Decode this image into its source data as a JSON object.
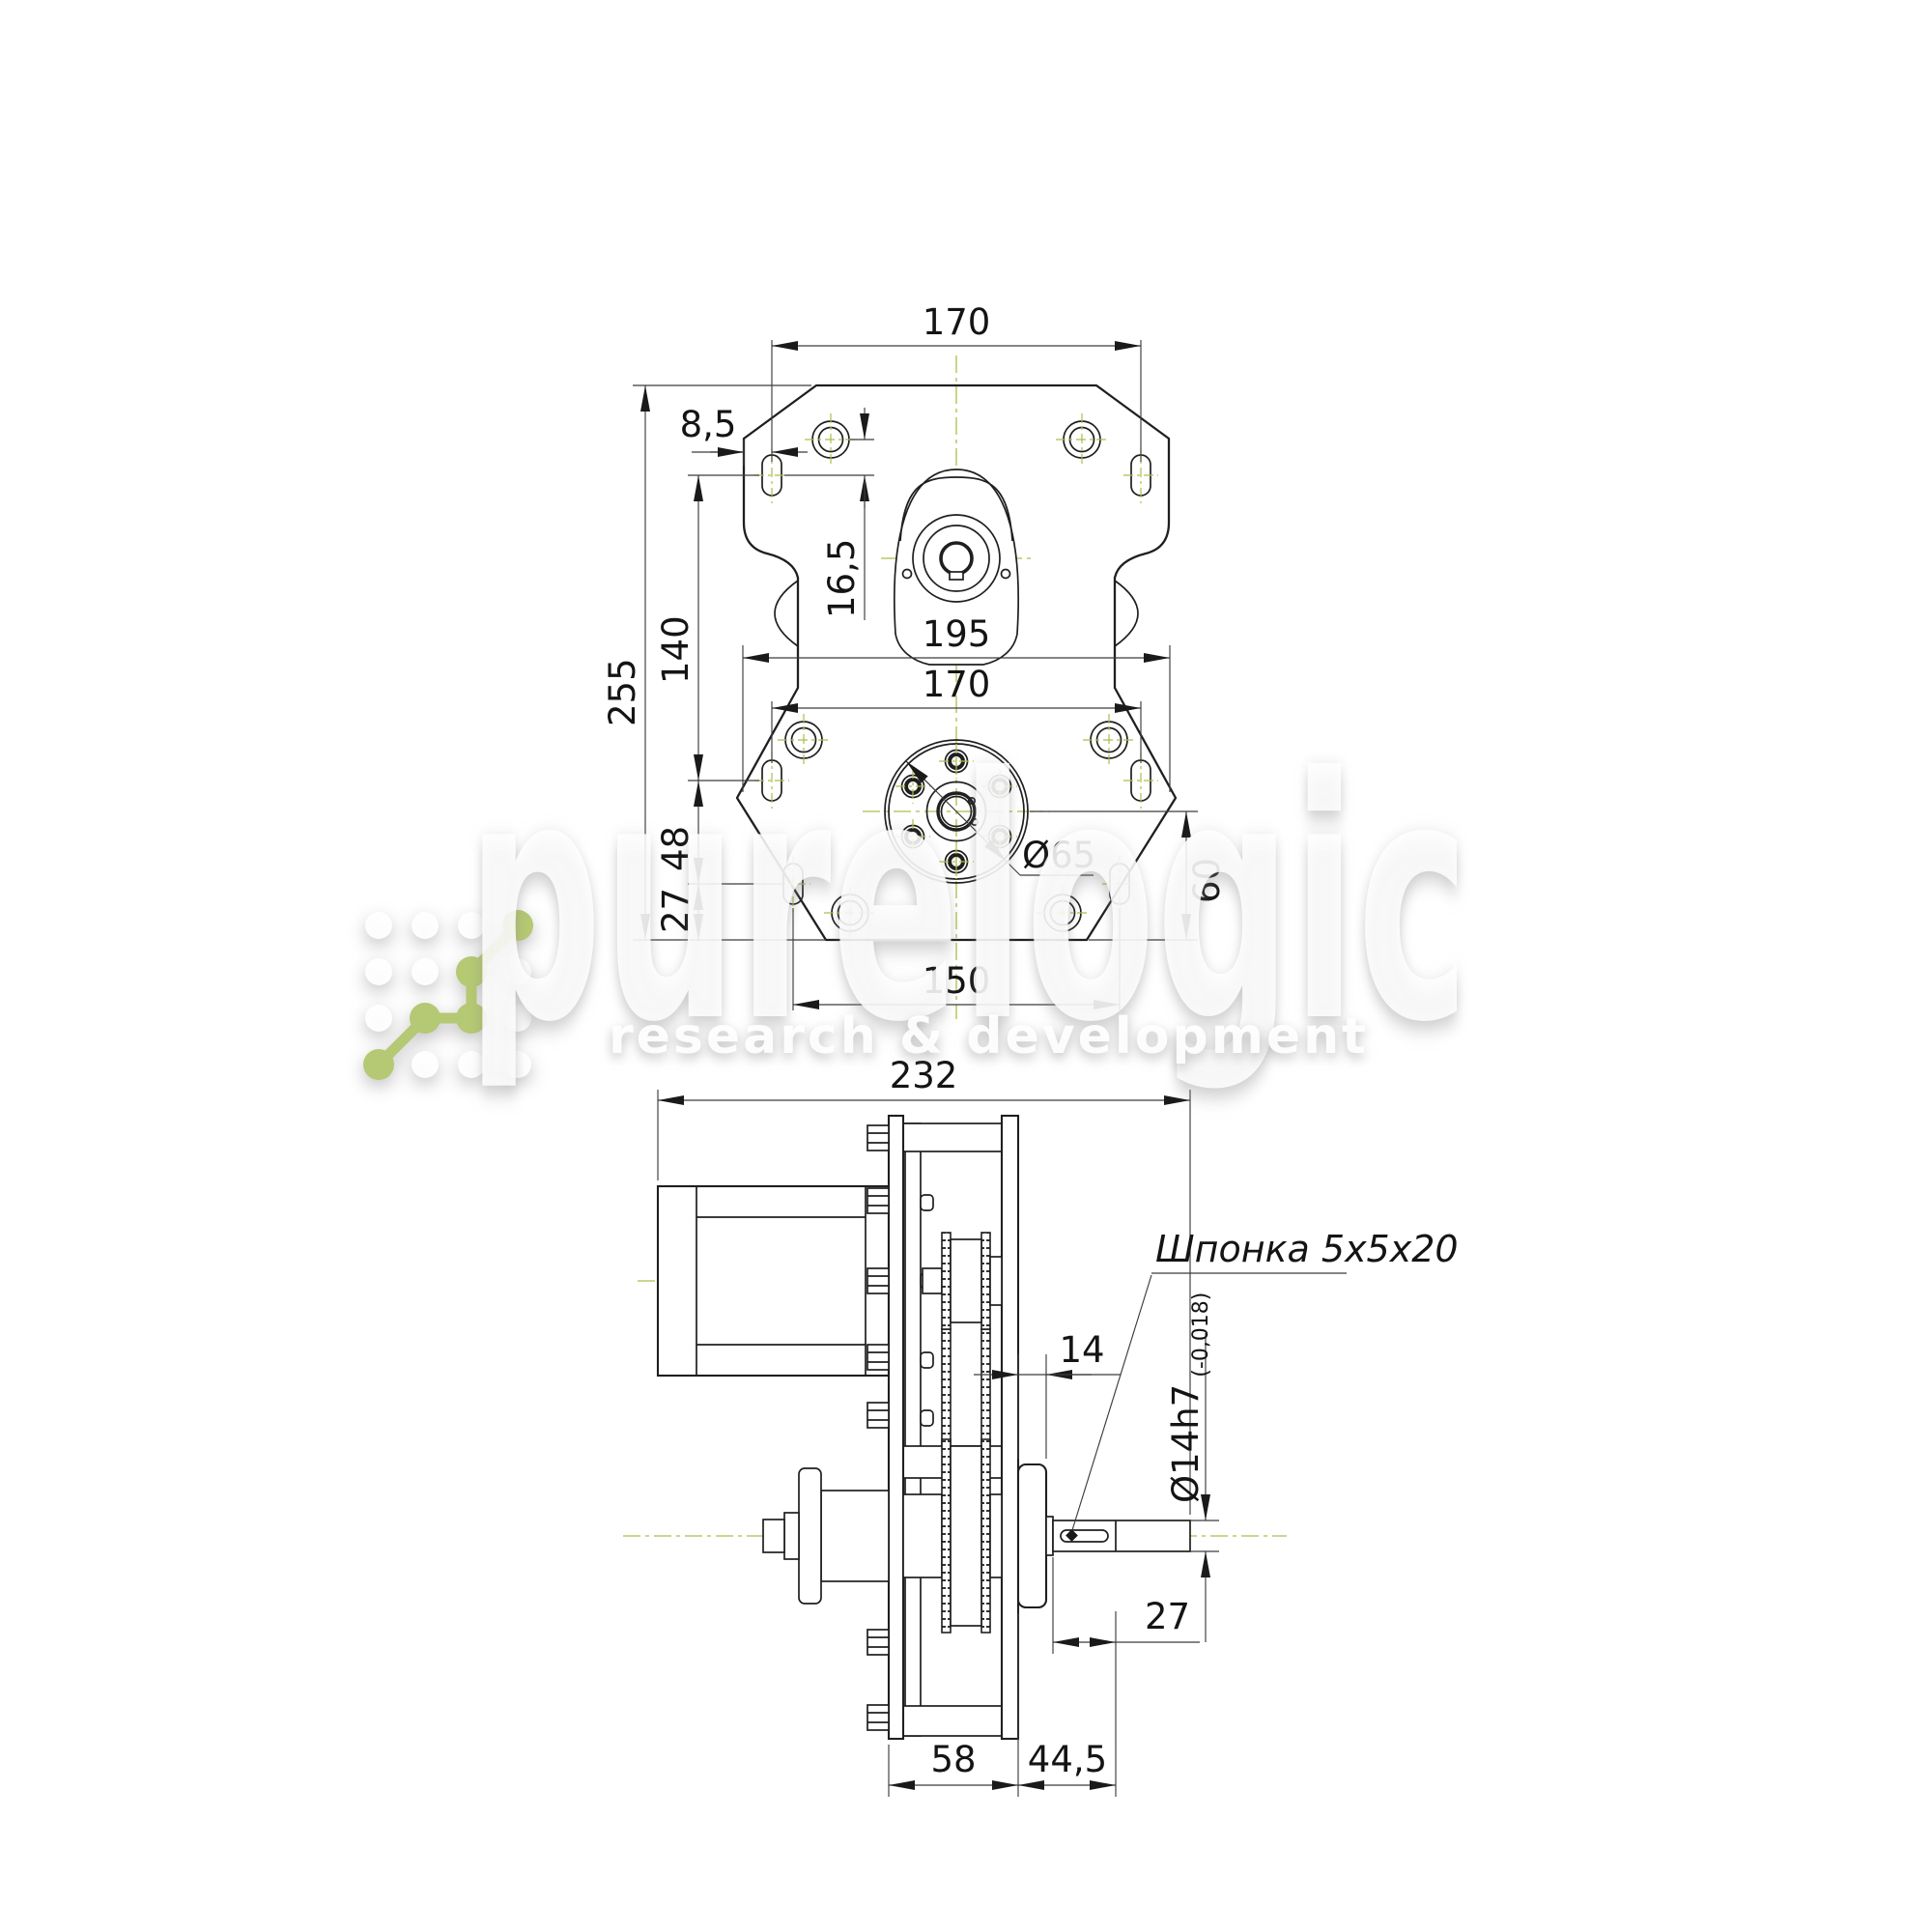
{
  "watermark": {
    "brand": "purelogic",
    "tagline": "research & development",
    "logo_green": "#b5c873"
  },
  "front_view": {
    "dims": {
      "width_top": "170",
      "edge_offset": "8,5",
      "hole_to_slot": "16,5",
      "slot_span": "140",
      "total_height": "255",
      "width_max": "195",
      "width_lower": "170",
      "slot_gap": "48",
      "slot_to_base": "27",
      "flange_dia": "Ø65",
      "flange_height": "60",
      "bottom_span": "150"
    }
  },
  "side_view": {
    "dims": {
      "total_length": "232",
      "flange_thickness": "14",
      "key_note": "Шпонка 5x5x20",
      "shaft_dia": "Ø14h7",
      "shaft_tol": "(-0,018)",
      "key_length": "27",
      "body_width": "58",
      "shaft_out": "44,5"
    }
  }
}
